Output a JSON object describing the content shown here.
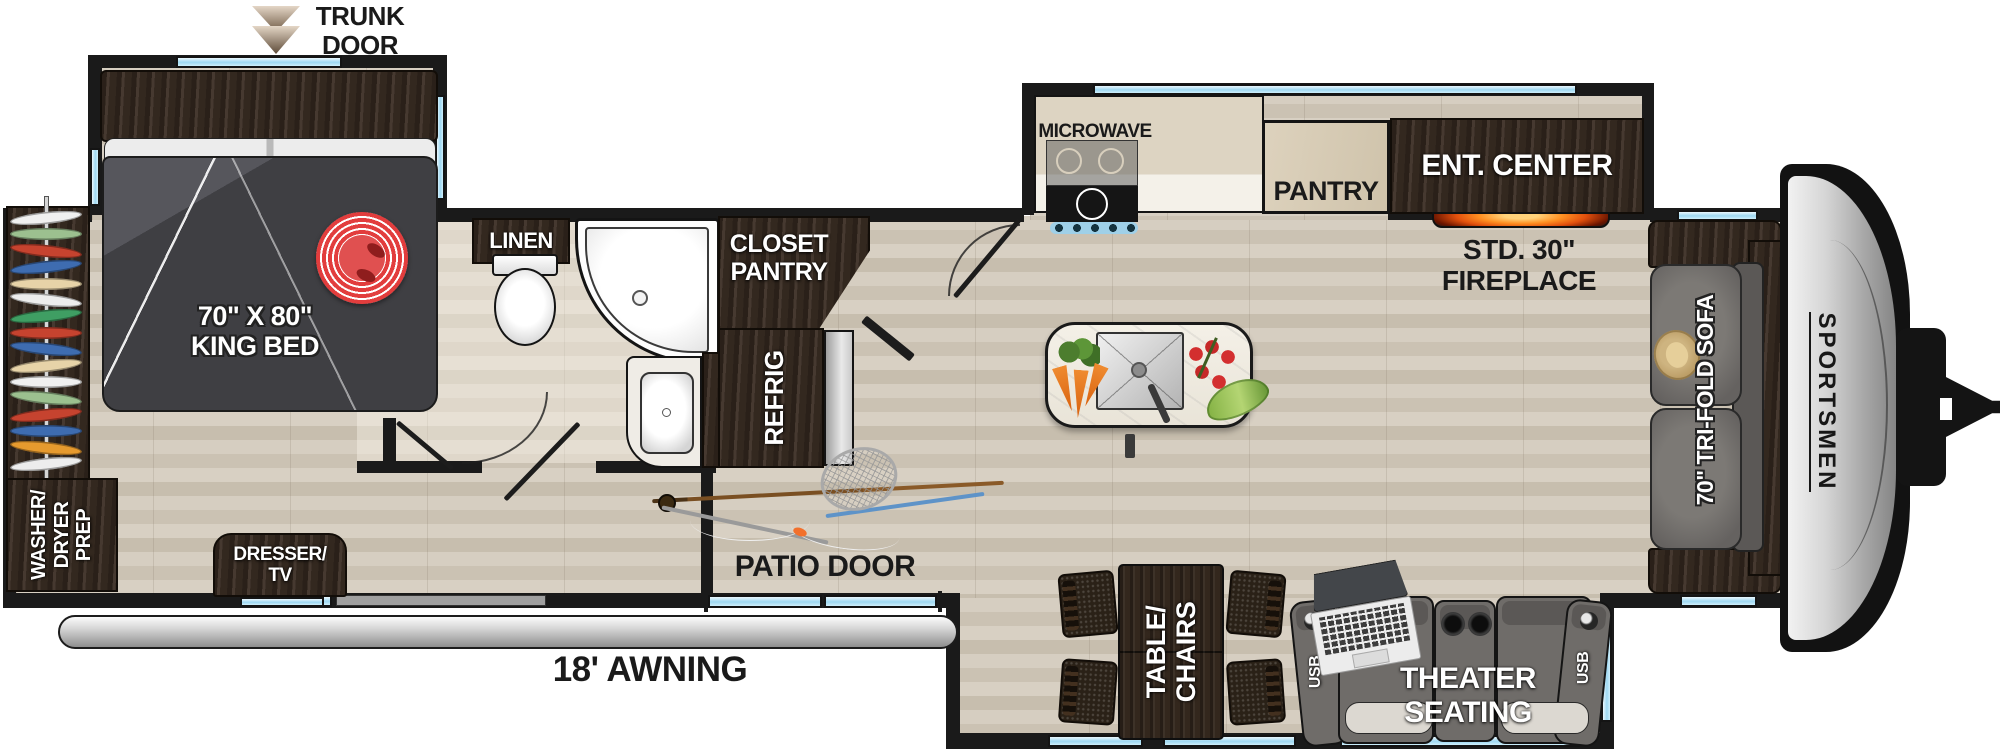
{
  "brand": "SPORTSMEN",
  "labels": {
    "trunk_door": [
      "TRUNK",
      "DOOR"
    ],
    "king_bed": [
      "70\" X 80\"",
      "KING BED"
    ],
    "washer_dryer_prep": [
      "WASHER/",
      "DRYER",
      "PREP"
    ],
    "dresser_tv": [
      "DRESSER/",
      "TV"
    ],
    "linen": "LINEN",
    "closet_pantry": [
      "CLOSET",
      "PANTRY"
    ],
    "refrig": "REFRIG",
    "microwave": "MICROWAVE",
    "pantry": "PANTRY",
    "ent_center": "ENT. CENTER",
    "fireplace": [
      "STD. 30\"",
      "FIREPLACE"
    ],
    "patio_door": "PATIO DOOR",
    "awning": "18' AWNING",
    "table_chairs": [
      "TABLE/",
      "CHAIRS"
    ],
    "theater_seating": [
      "THEATER",
      "SEATING"
    ],
    "usb": "USB",
    "tri_fold_sofa": "70\" TRI-FOLD SOFA"
  },
  "colors": {
    "wall": "#1a1a1a",
    "floor": "#d2c9bb",
    "dark_cabinet": "#3a2d23",
    "window": "#a6daf3",
    "counter": "#dbd2c0",
    "pantry_tan": "#d8cdb8",
    "fireplace_glow": "#ff8c1a",
    "rug_red": "#e23d3d",
    "sofa_gray": "#6f6c69",
    "cap_gray": "#c2c2c2",
    "awning_silver": "#cfcfcf"
  },
  "wardrobe": {
    "hanger_colors": [
      "#f0f0f0",
      "#9cc08f",
      "#c6432f",
      "#3e6cb0",
      "#e7d3a8",
      "#ededed",
      "#3f9e63",
      "#c6432f",
      "#3e6cb0",
      "#e7d3a8",
      "#f0f0f0",
      "#9cc08f",
      "#c6432f",
      "#3e6cb0",
      "#e69a2e",
      "#ededed"
    ]
  }
}
